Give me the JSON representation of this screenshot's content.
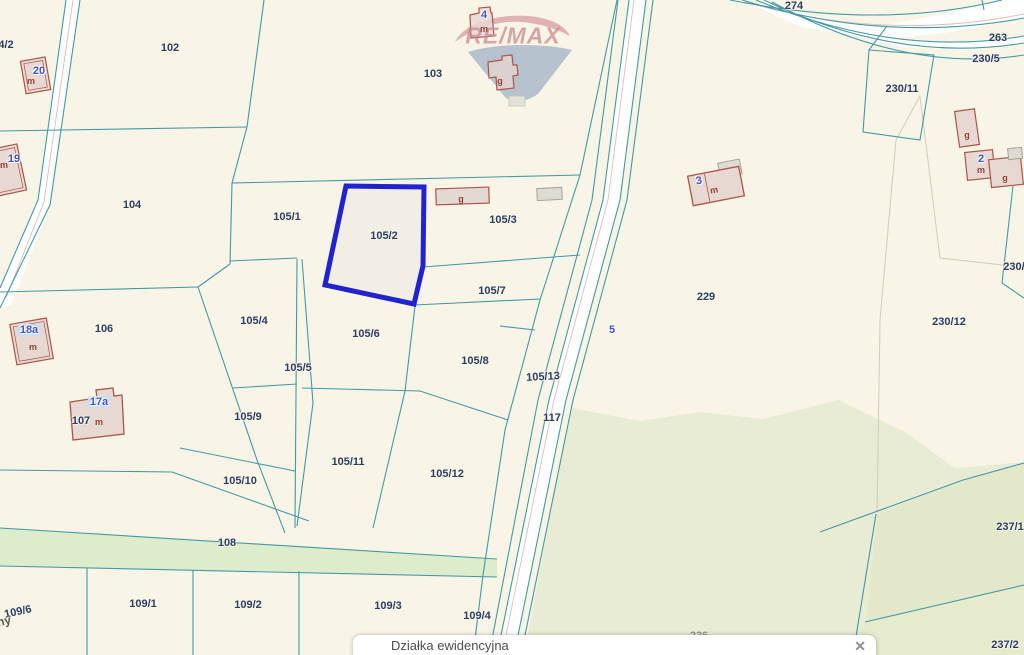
{
  "watermark": {
    "brand": "RE/MAX"
  },
  "info_bar": {
    "label": "Działka ewidencyjna",
    "close_icon": "✕"
  },
  "colors": {
    "background": "#f8f5e6",
    "parcel_line": "#4697a6",
    "highlight": "#2222cf",
    "parcel_label": "#2c3e66",
    "address_label": "#4152c8",
    "building_stroke": "#a8554e",
    "road_fill": "#ffffff",
    "green_strip": "#ddedcc",
    "green_area": "#e9ecd4"
  },
  "parcel_labels": {
    "l4_2": "4/2",
    "l102": "102",
    "l103": "103",
    "l104": "104",
    "l106": "106",
    "l107": "107",
    "l108": "108",
    "l117": "117",
    "l229": "229",
    "l263": "263",
    "l274": "274",
    "l105_1": "105/1",
    "l105_2": "105/2",
    "l105_3": "105/3",
    "l105_4": "105/4",
    "l105_5": "105/5",
    "l105_6": "105/6",
    "l105_7": "105/7",
    "l105_8": "105/8",
    "l105_9": "105/9",
    "l105_10": "105/10",
    "l105_11": "105/11",
    "l105_12": "105/12",
    "l105_13": "105/13",
    "l109_1": "109/1",
    "l109_2": "109/2",
    "l109_3": "109/3",
    "l109_4": "109/4",
    "l109_6": "109/6",
    "l230_5": "230/5",
    "l230_11": "230/11",
    "l230_12": "230/12",
    "l230_x": "230/",
    "l236": "236",
    "l237_1": "237/1",
    "l237_2": "237/2",
    "street_fragment": "ny"
  },
  "address_labels": {
    "a20": "20",
    "a19": "19",
    "a18a": "18a",
    "a17a": "17a",
    "a4": "4",
    "a3": "3",
    "a2": "2",
    "a5": "5"
  },
  "building_marks": {
    "m20": "m",
    "m19": "m",
    "m18a": "m",
    "m17a": "m",
    "m4": "m",
    "g1": "g",
    "g2": "g",
    "m3": "m",
    "g3": "g",
    "m2": "m",
    "g4": "g"
  }
}
